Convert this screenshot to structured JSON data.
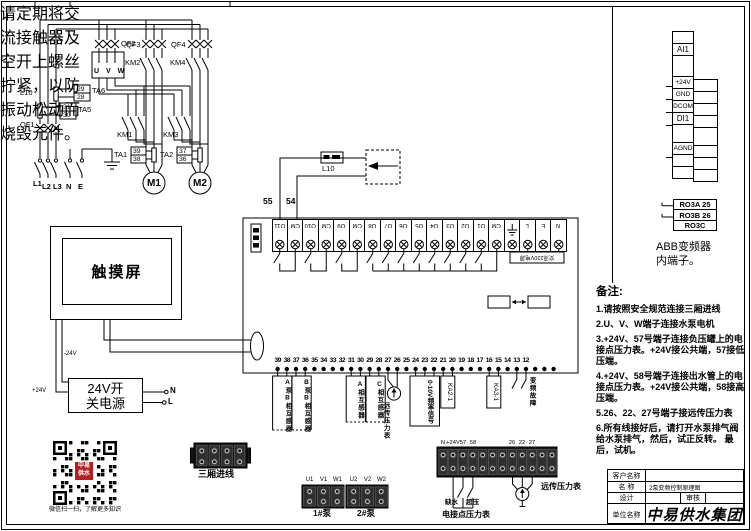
{
  "warning": {
    "lines": [
      "请定期将交",
      "流接触器及",
      "空开上螺丝",
      "拧紧，以防",
      "振动松动而",
      "烧毁元件。"
    ]
  },
  "power": {
    "l10": "L10",
    "qf1": "QF1",
    "qf2": "QF2",
    "qf3": "QF3",
    "qf4": "QF4",
    "km1": "KM1",
    "km2": "KM2",
    "km3": "KM3",
    "km4": "KM4",
    "ta1": "TA1",
    "ta2": "TA2",
    "ta5": "TA5",
    "ta6": "TA6",
    "ta1_terminals": [
      "39",
      "38"
    ],
    "ta2_terminals": [
      "37",
      "36"
    ],
    "ta5_terminals": [
      "31",
      "30"
    ],
    "ta6_terminals": [
      "29",
      "28"
    ],
    "inverter_output": "U V W",
    "motor1": "M1",
    "motor2": "M2",
    "phases": [
      "L1",
      "L2",
      "L3",
      "N",
      "E"
    ]
  },
  "sensor": {
    "label": "L10"
  },
  "controller": {
    "wire_labels": [
      "55",
      "54"
    ],
    "top_terminals": [
      "O11",
      "CM",
      "O10",
      "CM",
      "O9",
      "CM",
      "O8",
      "O7",
      "O6",
      "O5",
      "O4",
      "O3",
      "O2",
      "O1",
      "CM",
      "",
      "L",
      "E",
      "N"
    ],
    "mains_label": "交流220V电源",
    "bottom_terminals": [
      "39",
      "38",
      "37",
      "36",
      "35",
      "34",
      "33",
      "32",
      "31",
      "30",
      "29",
      "28",
      "27",
      "26",
      "25",
      "24",
      "23",
      "22",
      "21",
      "20",
      "19",
      "18",
      "17",
      "16",
      "15",
      "14",
      "13",
      "12"
    ],
    "attachments": {
      "ct_pump_a": "A泵B相互感器",
      "ct_pump_b": "B泵B相互感器",
      "ct_phase_a": "A相互感器",
      "ct_phase_c": "C相互感器",
      "remote_gauge": "远传压力表",
      "freq_signal": "0-10V频率信号",
      "ka2": "KA2-1",
      "ka3": "KA3-1",
      "vfd_fault": "变频故障"
    }
  },
  "abb": {
    "io_rows": [
      "",
      "AI1",
      "",
      "+24V",
      "GND",
      "DCOM",
      "DI1",
      "",
      "AGND",
      "",
      ""
    ],
    "relay_rows": [
      "RO3A 25",
      "RO3B 26",
      "RO3C"
    ],
    "caption": [
      "ABB变频器",
      "内端子。"
    ]
  },
  "hmi": {
    "label": "触摸屏"
  },
  "psu": {
    "line1": "24V开",
    "line2": "关电源",
    "plus": "+24V",
    "minus": "-24V",
    "n": "N",
    "l": "L"
  },
  "qr": {
    "caption": "微信扫一扫，了解更多知识",
    "logo_line1": "中易",
    "logo_line2": "供水",
    "logo_color": "#b3201f"
  },
  "io_blocks": {
    "mains_in": {
      "label": "三厢进线"
    },
    "pump1": {
      "terminals": [
        "U1",
        "V1",
        "W1"
      ],
      "label": "1#泵"
    },
    "pump2": {
      "terminals": [
        "U2",
        "V2",
        "W2"
      ],
      "label": "2#泵"
    },
    "pressure": {
      "top_labels": [
        "N",
        "+24V",
        "57",
        "58",
        "26",
        "22",
        "27"
      ],
      "switch_low": "缺水",
      "switch_high": "超压",
      "contact_gauge": "电接点压力表",
      "remote_gauge": "远传压力表"
    }
  },
  "notes": {
    "title": "备注:",
    "items": [
      "1.请按照安全规范连接三厢进线",
      "2.U、V、W端子连接水泵电机",
      "3.+24V、57号端子连接负压罐上的电接点压力表。+24V接公共端，57接低压端。",
      "4.+24V、58号端子连接出水管上的电接点压力表。+24V接公共端，58接高压端。",
      "5.26、22、27号端子接远传压力表",
      "6.所有线接好后，请打开水泵排气阀给水泵排气，然后，试正反转。 最后，试机。"
    ]
  },
  "title_block": {
    "customer_label": "客户名称",
    "customer_value": "",
    "name_label": "名  称",
    "name_value": "2泵变频控制原理图",
    "design_label": "设计",
    "design_value": "",
    "review_label": "审核",
    "review_value": "",
    "company_label": "单位名称",
    "company_value": "中易供水集团"
  }
}
